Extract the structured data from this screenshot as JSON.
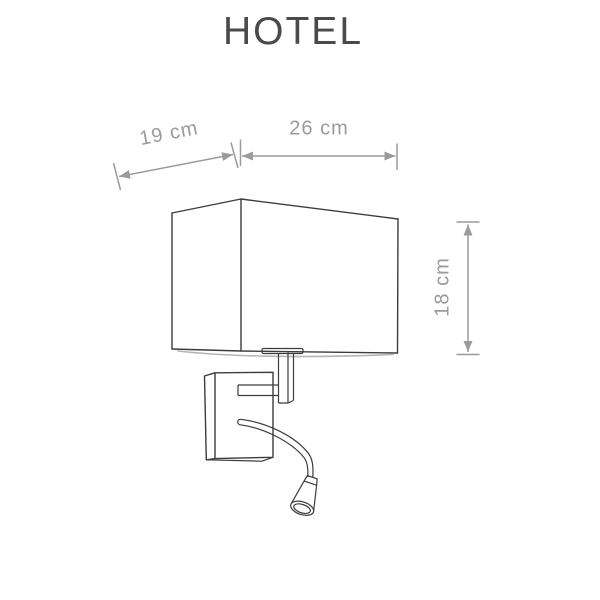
{
  "title": "HOTEL",
  "dimensions": {
    "side_depth": {
      "label": "19 cm"
    },
    "front_width": {
      "label": "26 cm"
    },
    "height": {
      "label": "18 cm"
    }
  },
  "drawing": {
    "name": "wall-lamp-with-flexible-reading-light"
  },
  "colors": {
    "background": "#ffffff",
    "title_text": "#4a4a4a",
    "dimension_gray": "#9b9b9b",
    "drawing_line": "#3c3c3c"
  }
}
